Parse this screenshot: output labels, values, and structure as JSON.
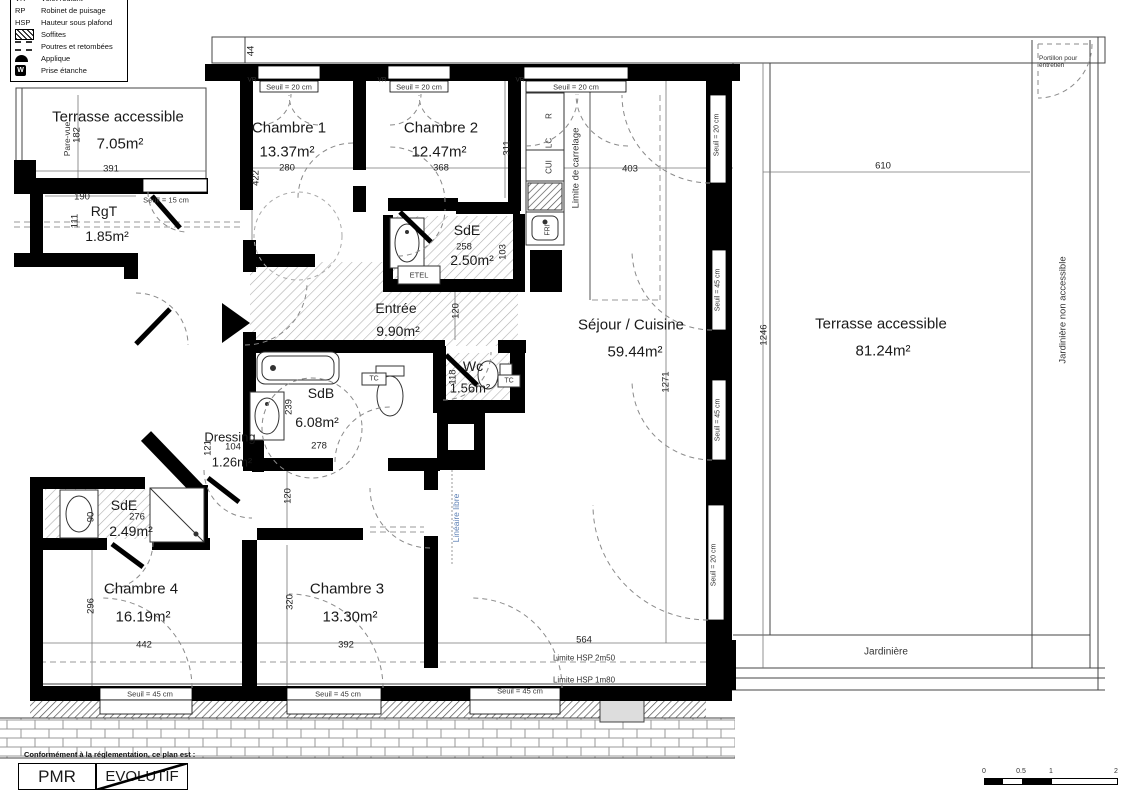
{
  "legend": {
    "rows": [
      {
        "abbr": "VR",
        "label": "Volet roulant"
      },
      {
        "abbr": "RP",
        "label": "Robinet de puisage"
      },
      {
        "abbr": "HSP",
        "label": "Hauteur sous plafond"
      },
      {
        "abbr": "",
        "label": "Soffites"
      },
      {
        "abbr": "",
        "label": "Poutres et retombées"
      },
      {
        "abbr": "",
        "label": "Applique"
      },
      {
        "abbr": "",
        "label": "Prise étanche"
      }
    ],
    "prise_glyph": "W"
  },
  "rooms": {
    "terrasse_nw": {
      "name": "Terrasse accessible",
      "area": "7.05m²"
    },
    "rgt": {
      "name": "RgT",
      "area": "1.85m²"
    },
    "chambre1": {
      "name": "Chambre 1",
      "area": "13.37m²"
    },
    "chambre2": {
      "name": "Chambre 2",
      "area": "12.47m²"
    },
    "sde_haut": {
      "name": "SdE",
      "area": "2.50m²"
    },
    "entree": {
      "name": "Entrée",
      "area": "9.90m²"
    },
    "sejour": {
      "name": "Séjour / Cuisine",
      "area": "59.44m²"
    },
    "sdb": {
      "name": "SdB",
      "area": "6.08m²"
    },
    "wc": {
      "name": "Wc",
      "area": "1.56m²"
    },
    "dressing": {
      "name": "Dressing",
      "area": "1.26m²"
    },
    "sde_bas": {
      "name": "SdE",
      "area": "2.49m²"
    },
    "chambre4": {
      "name": "Chambre 4",
      "area": "16.19m²"
    },
    "chambre3": {
      "name": "Chambre 3",
      "area": "13.30m²"
    },
    "terrasse_e": {
      "name": "Terrasse accessible",
      "area": "81.24m²"
    }
  },
  "dims": {
    "top_band": "44",
    "terrasse_nw_h": "182",
    "terrasse_nw_w": "391",
    "rgt_w": "190",
    "rgt_h": "111",
    "chambre1_h": "422",
    "chambre1_w": "280",
    "chambre2_w": "368",
    "chambre2_h": "311",
    "cuisine_w": "403",
    "sde_haut_w": "258",
    "sde_haut_h": "103",
    "entree_h": "120",
    "sdb_h": "239",
    "sdb_w": "278",
    "wc_h": "118",
    "dressing_h": "121",
    "dressing_w": "104",
    "sde_bas_w": "276",
    "sde_bas_h": "90",
    "couloir_w": "120",
    "chambre4_h": "296",
    "chambre3_h": "320",
    "chambre4_w": "442",
    "chambre3_w": "392",
    "sejour_w": "564",
    "sejour_h": "1271",
    "terrasse_e_w": "610",
    "terrasse_e_h": "1246"
  },
  "ann": {
    "pare_vue": "Pare-vue",
    "seuil15": "Seuil = 15 cm",
    "seuil20": "Seuil = 20 cm",
    "seuil45": "Seuil = 45 cm",
    "vr": "VR",
    "k_r": "R",
    "k_lc": "LC",
    "k_cui": "CUI",
    "k_fri": "FRI",
    "limite_carrelage": "Limite de carrelage",
    "etel": "ETEL",
    "tc": "TC",
    "lineaire_libre": "Linéaire libre",
    "limite_hsp_250": "Limite HSP 2m50",
    "limite_hsp_180": "Limite HSP 1m80",
    "jardiniere_na": "Jardinière non accessible",
    "jardiniere": "Jardinière",
    "portillon": "Portillon pour entretien"
  },
  "footer": {
    "note": "Conformément à la réglementation, ce plan est :",
    "pmr": "PMR",
    "evolutif": "EVOLUTIF"
  },
  "scalebar": {
    "t0": "0",
    "t05": "0.5",
    "t1": "1",
    "t2": "2"
  }
}
